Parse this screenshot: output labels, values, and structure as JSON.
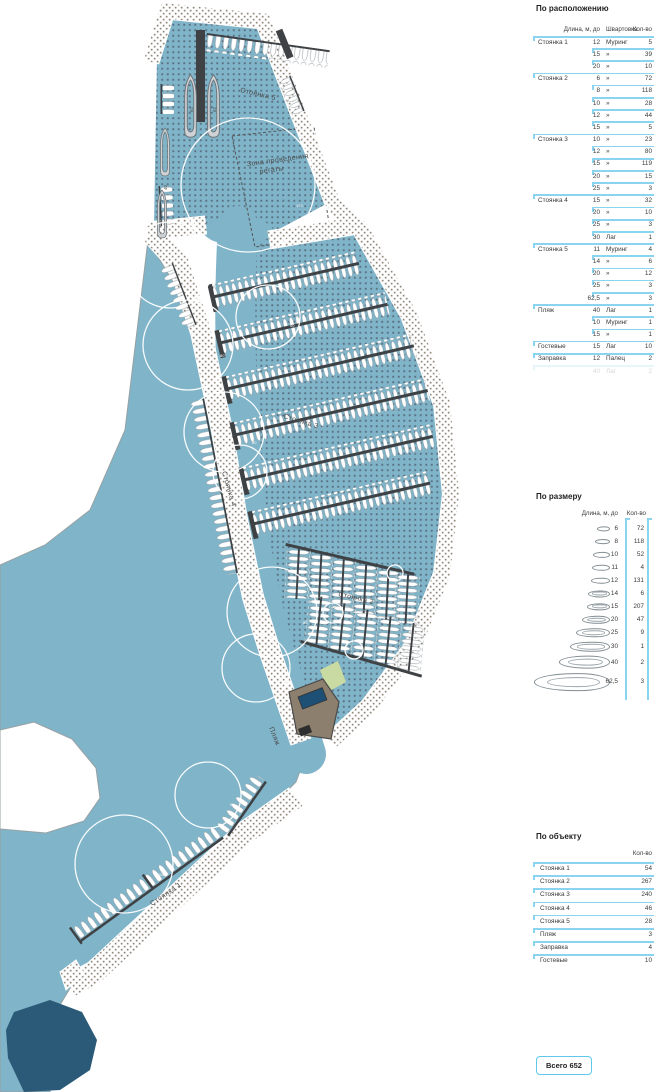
{
  "panel": {
    "by_location": {
      "title": "По расположению",
      "headers": {
        "len": "Длина, м, до",
        "moor": "Швартовка",
        "qty": "Кол-во"
      },
      "rows": [
        {
          "group": "Стоянка 1",
          "len": "12",
          "moor": "Муринг",
          "qty": "5",
          "start": true
        },
        {
          "group": "",
          "len": "15",
          "moor": "»",
          "qty": "39"
        },
        {
          "group": "",
          "len": "20",
          "moor": "»",
          "qty": "10"
        },
        {
          "group": "Стоянка 2",
          "len": "6",
          "moor": "»",
          "qty": "72",
          "start": true
        },
        {
          "group": "",
          "len": "8",
          "moor": "»",
          "qty": "118"
        },
        {
          "group": "",
          "len": "10",
          "moor": "»",
          "qty": "28"
        },
        {
          "group": "",
          "len": "12",
          "moor": "»",
          "qty": "44"
        },
        {
          "group": "",
          "len": "15",
          "moor": "»",
          "qty": "5"
        },
        {
          "group": "Стоянка 3",
          "len": "10",
          "moor": "»",
          "qty": "23",
          "start": true
        },
        {
          "group": "",
          "len": "12",
          "moor": "»",
          "qty": "80"
        },
        {
          "group": "",
          "len": "15",
          "moor": "»",
          "qty": "119"
        },
        {
          "group": "",
          "len": "20",
          "moor": "»",
          "qty": "15"
        },
        {
          "group": "",
          "len": "25",
          "moor": "»",
          "qty": "3"
        },
        {
          "group": "Стоянка 4",
          "len": "15",
          "moor": "»",
          "qty": "32",
          "start": true
        },
        {
          "group": "",
          "len": "20",
          "moor": "»",
          "qty": "10"
        },
        {
          "group": "",
          "len": "25",
          "moor": "»",
          "qty": "3"
        },
        {
          "group": "",
          "len": "30",
          "moor": "Лаг",
          "qty": "1"
        },
        {
          "group": "Стоянка 5",
          "len": "11",
          "moor": "Муринг",
          "qty": "4",
          "start": true
        },
        {
          "group": "",
          "len": "14",
          "moor": "»",
          "qty": "6"
        },
        {
          "group": "",
          "len": "20",
          "moor": "»",
          "qty": "12"
        },
        {
          "group": "",
          "len": "25",
          "moor": "»",
          "qty": "3"
        },
        {
          "group": "",
          "len": "62,5",
          "moor": "»",
          "qty": "3"
        },
        {
          "group": "Пляж",
          "len": "40",
          "moor": "Лаг",
          "qty": "1",
          "start": true
        },
        {
          "group": "",
          "len": "10",
          "moor": "Муринг",
          "qty": "1"
        },
        {
          "group": "",
          "len": "15",
          "moor": "»",
          "qty": "1"
        },
        {
          "group": "Гостевые",
          "len": "15",
          "moor": "Лаг",
          "qty": "10",
          "start": true
        },
        {
          "group": "Заправка",
          "len": "12",
          "moor": "Палец",
          "qty": "2",
          "start": true
        },
        {
          "group": "",
          "len": "40",
          "moor": "Лаг",
          "qty": "2",
          "start": true,
          "faint": true
        }
      ]
    },
    "by_size": {
      "title": "По размеру",
      "headers": {
        "len": "Длина, м, до",
        "qty": "Кол-во"
      },
      "rows": [
        {
          "len": "6",
          "qty": "72"
        },
        {
          "len": "8",
          "qty": "118"
        },
        {
          "len": "10",
          "qty": "52"
        },
        {
          "len": "11",
          "qty": "4"
        },
        {
          "len": "12",
          "qty": "131"
        },
        {
          "len": "14",
          "qty": "6"
        },
        {
          "len": "15",
          "qty": "207"
        },
        {
          "len": "20",
          "qty": "47"
        },
        {
          "len": "25",
          "qty": "9"
        },
        {
          "len": "30",
          "qty": "1"
        },
        {
          "len": "40",
          "qty": "2"
        },
        {
          "len": "62,5",
          "qty": "3"
        }
      ]
    },
    "by_object": {
      "title": "По объекту",
      "headers": {
        "qty": "Кол-во"
      },
      "rows": [
        {
          "name": "Стоянка 1",
          "qty": "54"
        },
        {
          "name": "Стоянка 2",
          "qty": "267"
        },
        {
          "name": "Стоянка 3",
          "qty": "240"
        },
        {
          "name": "Стоянка 4",
          "qty": "46"
        },
        {
          "name": "Стоянка 5",
          "qty": "28"
        },
        {
          "name": "Пляж",
          "qty": "3"
        },
        {
          "name": "Заправка",
          "qty": "4"
        },
        {
          "name": "Гостевые",
          "qty": "10"
        }
      ]
    },
    "total_label": "Всего 652"
  },
  "map": {
    "labels": {
      "st5": "Стоянка 5",
      "regatta_line1": "Зона проведения",
      "regatta_line2": "регаты",
      "st3": "Стоянка 3",
      "st4": "Стоянка 4",
      "st2": "Стоянка 2",
      "beach": "Пляж",
      "st1": "Стоянка 1"
    },
    "yachts": [
      {
        "label": "62"
      },
      {
        "label": "62"
      },
      {
        "label": "40"
      }
    ],
    "circles": [
      {
        "label": "140"
      },
      {
        "label": "80"
      },
      {
        "label": "80"
      },
      {
        "label": "50"
      },
      {
        "label": "80"
      },
      {
        "label": "50"
      },
      {
        "label": "80"
      },
      {
        "label": "50"
      },
      {
        "label": "50"
      },
      {
        "label": "110"
      }
    ]
  },
  "colors": {
    "accent": "#8ad4ef",
    "water": "#7fb4c9",
    "water_dot": "#5b7282",
    "land_dot": "#8f8679",
    "pier": "#3f4245",
    "deep_water": "#2a5a78",
    "building": "#8d7f6d",
    "pool": "#1e4f74",
    "lawn": "#c9daa2"
  }
}
